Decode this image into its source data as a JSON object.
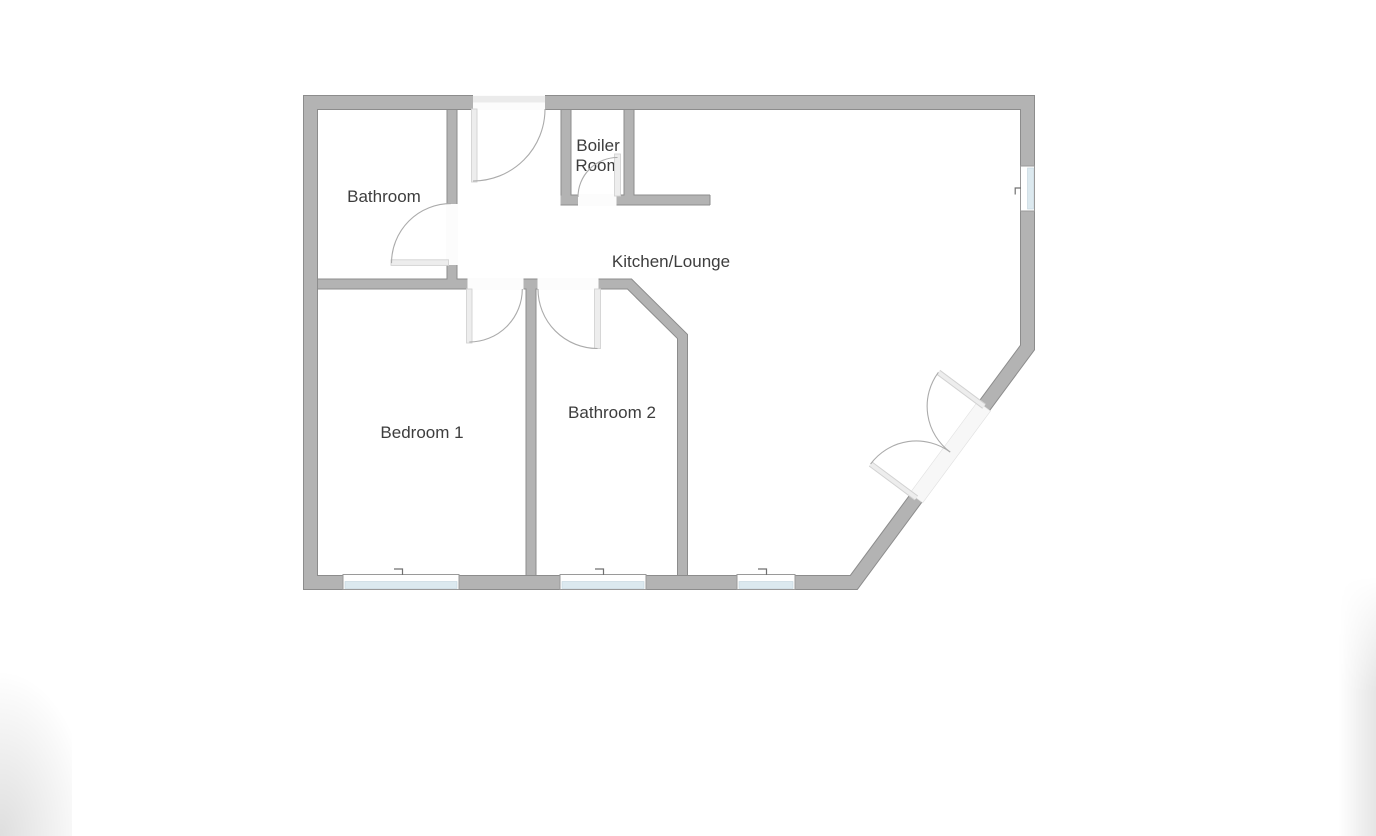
{
  "floor_plan": {
    "rooms": {
      "bathroom": {
        "label": "Bathroom"
      },
      "boiler_room": {
        "label_line1": "Boiler",
        "label_line2": "Room"
      },
      "kitchen_lounge": {
        "label": "Kitchen/Lounge"
      },
      "bedroom_1": {
        "label": "Bedroom 1"
      },
      "bathroom_2": {
        "label": "Bathroom 2"
      }
    },
    "features": {
      "doors": [
        "entry-door-top",
        "bathroom-door",
        "boiler-room-door",
        "bedroom-1-door",
        "bathroom-2-door",
        "double-door-diagonal"
      ],
      "windows": [
        "bottom-window-bedroom-1",
        "bottom-window-bathroom-2",
        "bottom-window-kitchen",
        "right-window-kitchen"
      ]
    },
    "colors": {
      "wall_fill": "#b3b3b3",
      "wall_edge": "#8c8c8c",
      "window_glass": "#dce9ef",
      "window_border": "#9a9a9a",
      "door_leaf": "#ededed",
      "door_leaf_edge": "#d2d2d2",
      "door_arc": "#ababab",
      "label_text": "#3d3d3d"
    }
  }
}
